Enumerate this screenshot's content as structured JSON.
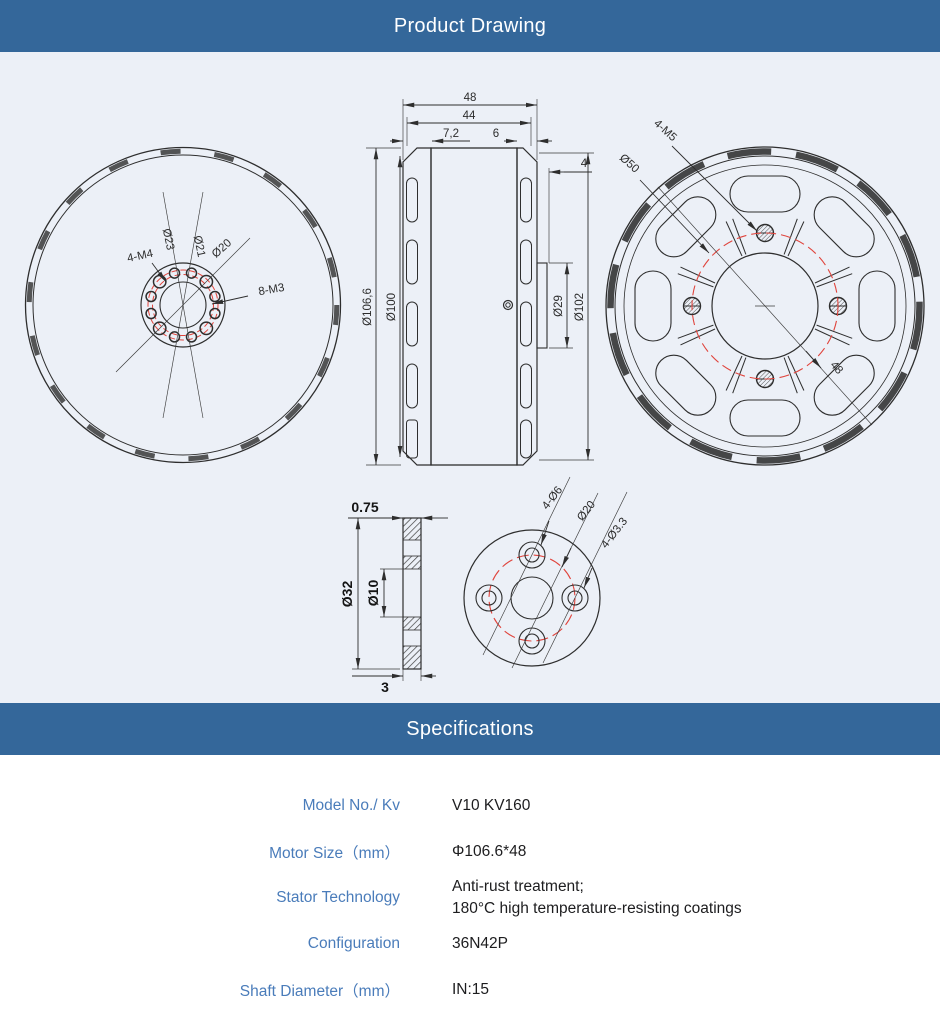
{
  "colors": {
    "accent": "#34679a",
    "drawing_bg": "#ecf0f7",
    "label_blue": "#4a7cba",
    "value_dark": "#1d1d1f",
    "line": "#2e2e2e",
    "red": "#e0443c"
  },
  "header": {
    "title": "Product Drawing"
  },
  "specs_header": {
    "title": "Specifications"
  },
  "drawing": {
    "front_view": {
      "labels": {
        "m4": "4-M4",
        "d23": "Ø23",
        "d21": "Ø21",
        "d20": "Ø20",
        "m3": "8-M3"
      }
    },
    "side_view": {
      "labels": {
        "len48": "48",
        "len44": "44",
        "len7_2": "7,2",
        "len6": "6",
        "len4": "4",
        "d106_6": "Ø106,6",
        "d100": "Ø100",
        "d29": "Ø29",
        "d102": "Ø102"
      }
    },
    "back_view": {
      "labels": {
        "m5": "4-M5",
        "d50": "Ø50",
        "len48": "48"
      }
    },
    "section_view": {
      "labels": {
        "t0_75": "0.75",
        "d32": "Ø32",
        "d10": "Ø10",
        "t3": "3"
      }
    },
    "flange_view": {
      "labels": {
        "holes_d6": "4-Ø6",
        "d20": "Ø20",
        "holes_d3_3": "4-Ø3.3"
      }
    }
  },
  "specs": {
    "rows": [
      {
        "label": "Model No./ Kv",
        "lines": [
          "V10 KV160"
        ]
      },
      {
        "label": "Motor Size（mm）",
        "lines": [
          "Φ106.6*48"
        ]
      },
      {
        "label": "Stator Technology",
        "lines": [
          "Anti-rust treatment;",
          "180°C high temperature-resisting coatings"
        ]
      },
      {
        "label": "Configuration",
        "lines": [
          "36N42P"
        ]
      },
      {
        "label": "Shaft Diameter（mm）",
        "lines": [
          "IN:15"
        ]
      }
    ]
  }
}
